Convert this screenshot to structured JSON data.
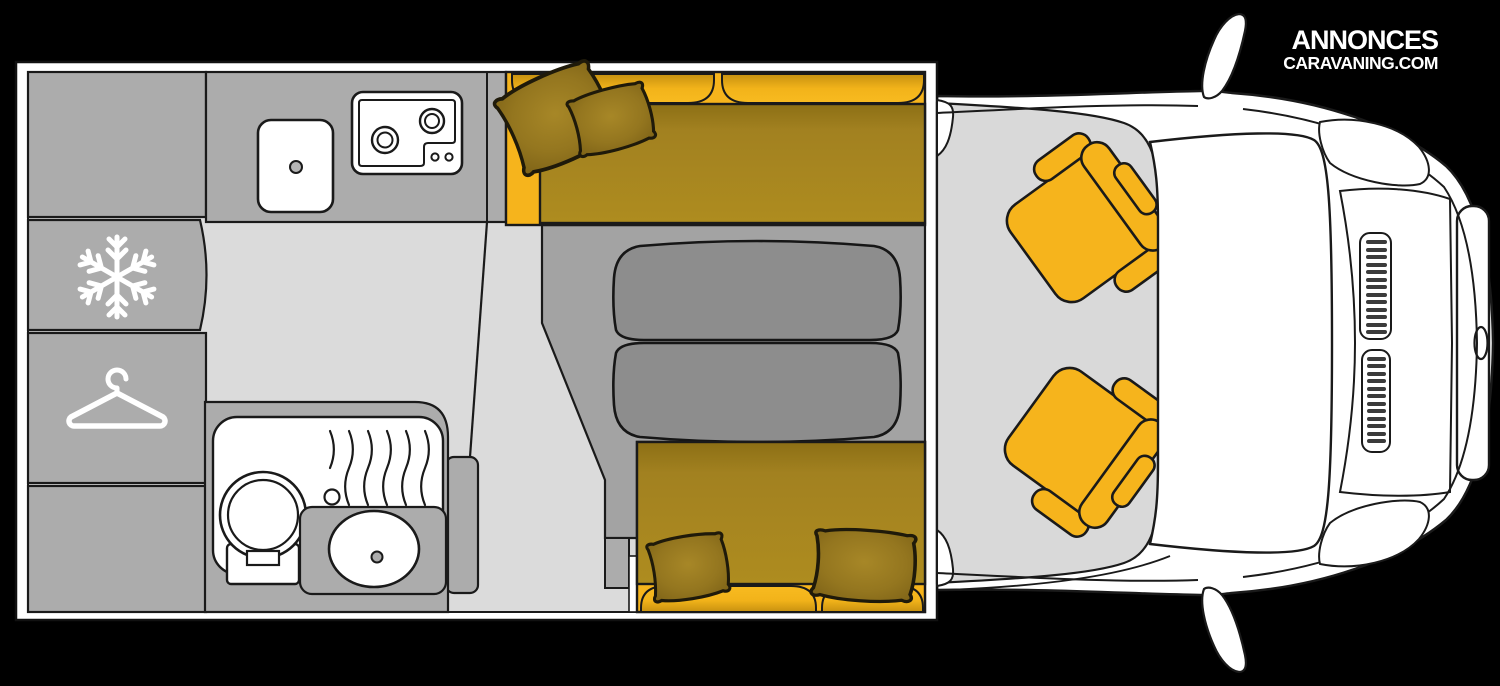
{
  "logo": {
    "line1": "ANNONCES",
    "line2": "CARAVANING.COM"
  },
  "diagram": {
    "type": "motorhome-floor-plan-top-view",
    "areas": [
      "overhead-cabinet",
      "fridge",
      "wardrobe",
      "lower-cabinet",
      "kitchen-counter",
      "sink",
      "two-burner-hob",
      "bathroom",
      "shower-tray",
      "toilet",
      "washbasin",
      "dinette-front-bench",
      "dinette-rear-bench",
      "dinette-table",
      "passenger-swivel-seat",
      "driver-swivel-seat",
      "cab",
      "vehicle-front"
    ],
    "icons": [
      "snowflake-icon",
      "hanger-icon"
    ]
  },
  "colors": {
    "background": "#000000",
    "body_white": "#ffffff",
    "outline": "#1a1a1a",
    "floor": "#dbdbdb",
    "cabinet_gray": "#acacac",
    "platform_gray": "#a3a3a3",
    "table_gray": "#8d8d8d",
    "accent_yellow": "#f6b41c",
    "seat_mustard": "#a8861c"
  }
}
